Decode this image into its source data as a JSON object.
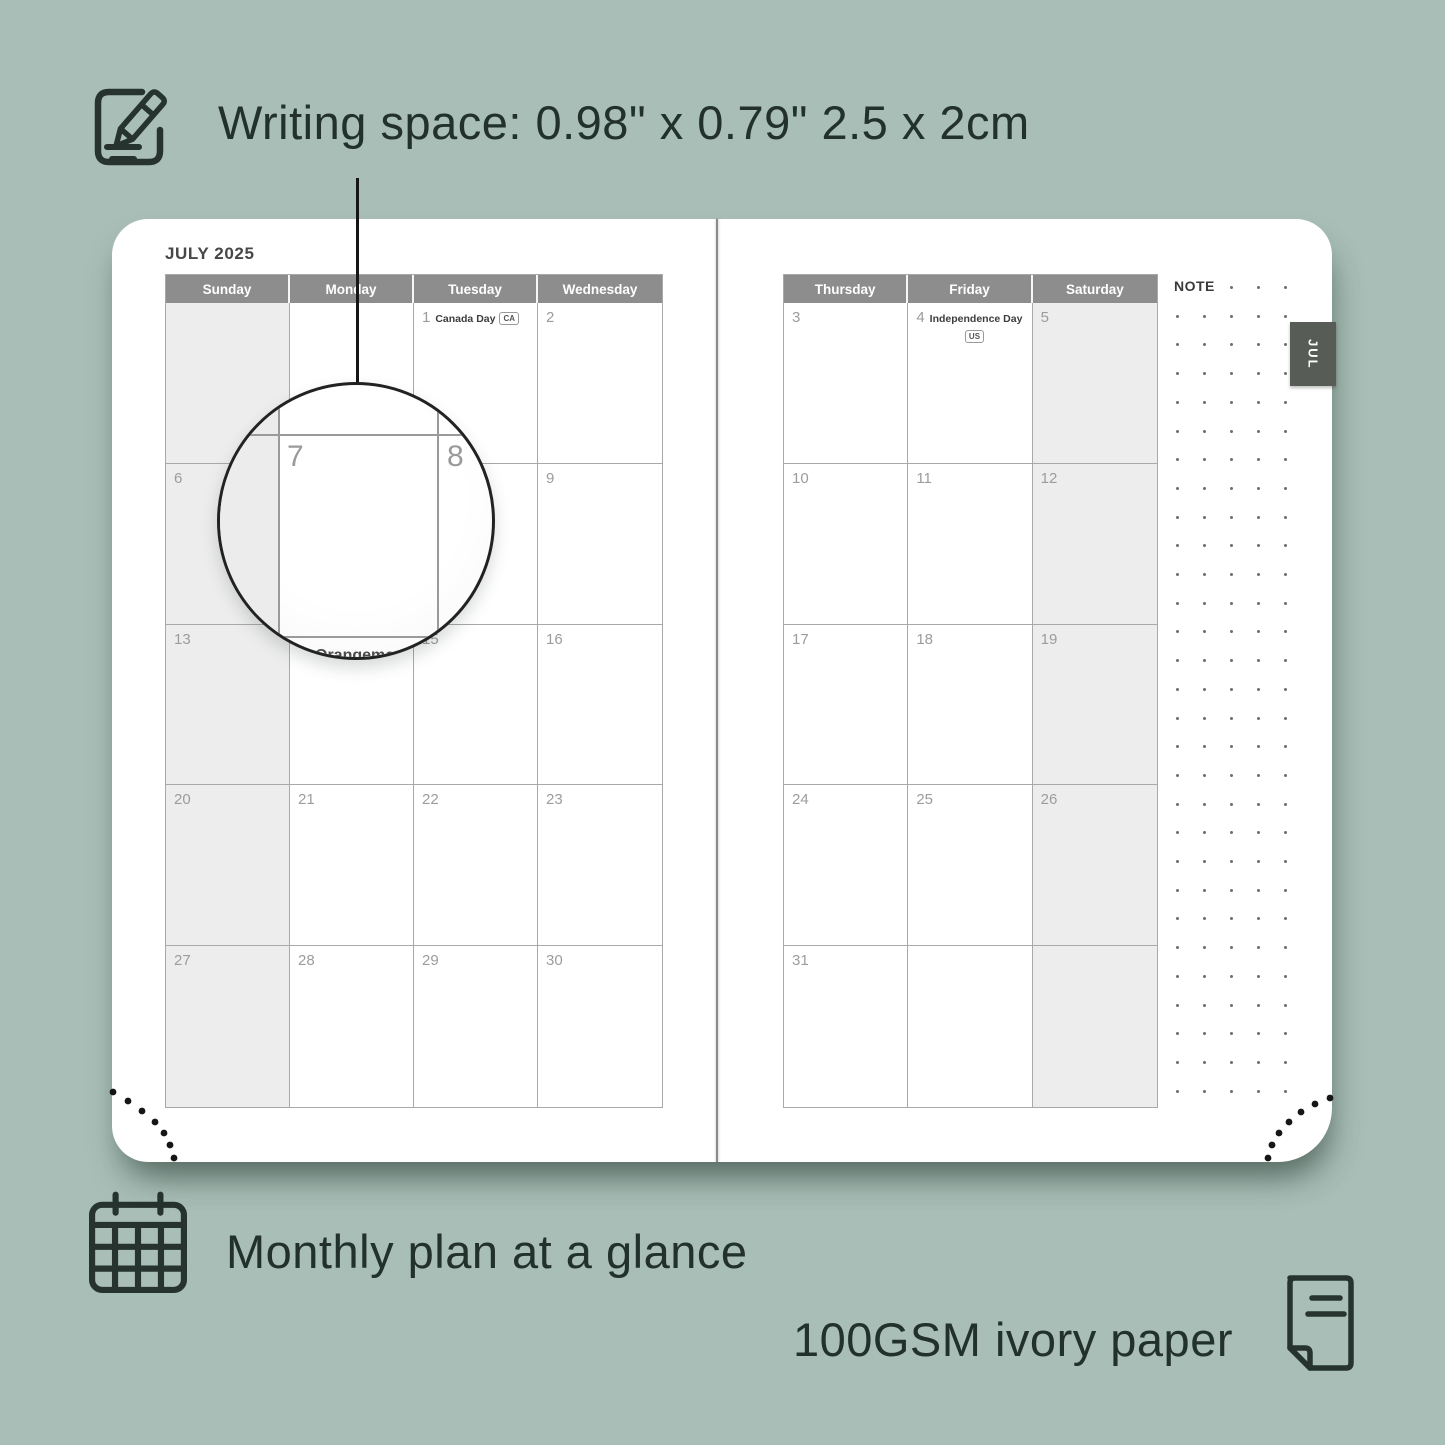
{
  "colors": {
    "background": "#a8beb6",
    "header_gray": "#8d8d8d",
    "tab_gray": "#575c57",
    "shaded_cell": "#ededed"
  },
  "captions": {
    "writing_space": "Writing space: 0.98\" x 0.79\" 2.5 x 2cm",
    "monthly": "Monthly plan at a glance",
    "paper": "100GSM ivory paper"
  },
  "planner": {
    "month_title": "JULY 2025",
    "note_label": "NOTE",
    "tab_label": "JUL",
    "left_page": {
      "headers": [
        "Sunday",
        "Monday",
        "Tuesday",
        "Wednesday"
      ],
      "shaded_col": 0,
      "weeks": [
        [
          {
            "num": ""
          },
          {
            "num": ""
          },
          {
            "num": "1",
            "event": "Canada Day",
            "badge": "CA",
            "badge_below": false
          },
          {
            "num": "2"
          }
        ],
        [
          {
            "num": "6"
          },
          {
            "num": "7"
          },
          {
            "num": "8"
          },
          {
            "num": "9"
          }
        ],
        [
          {
            "num": "13"
          },
          {
            "num": "14",
            "event": "Orangemen's Day"
          },
          {
            "num": "15"
          },
          {
            "num": "16"
          }
        ],
        [
          {
            "num": "20"
          },
          {
            "num": "21"
          },
          {
            "num": "22"
          },
          {
            "num": "23"
          }
        ],
        [
          {
            "num": "27"
          },
          {
            "num": "28"
          },
          {
            "num": "29"
          },
          {
            "num": "30"
          }
        ]
      ]
    },
    "right_page": {
      "headers": [
        "Thursday",
        "Friday",
        "Saturday"
      ],
      "shaded_col": 2,
      "weeks": [
        [
          {
            "num": "3"
          },
          {
            "num": "4",
            "event": "Independence Day",
            "badge": "US",
            "badge_below": true
          },
          {
            "num": "5"
          }
        ],
        [
          {
            "num": "10"
          },
          {
            "num": "11"
          },
          {
            "num": "12"
          }
        ],
        [
          {
            "num": "17"
          },
          {
            "num": "18"
          },
          {
            "num": "19"
          }
        ],
        [
          {
            "num": "24"
          },
          {
            "num": "25"
          },
          {
            "num": "26"
          }
        ],
        [
          {
            "num": "31"
          },
          {
            "num": ""
          },
          {
            "num": ""
          }
        ]
      ]
    }
  },
  "magnifier": {
    "primary_day": "7",
    "adjacent_day": "8",
    "event_text": "Orangemen's"
  }
}
